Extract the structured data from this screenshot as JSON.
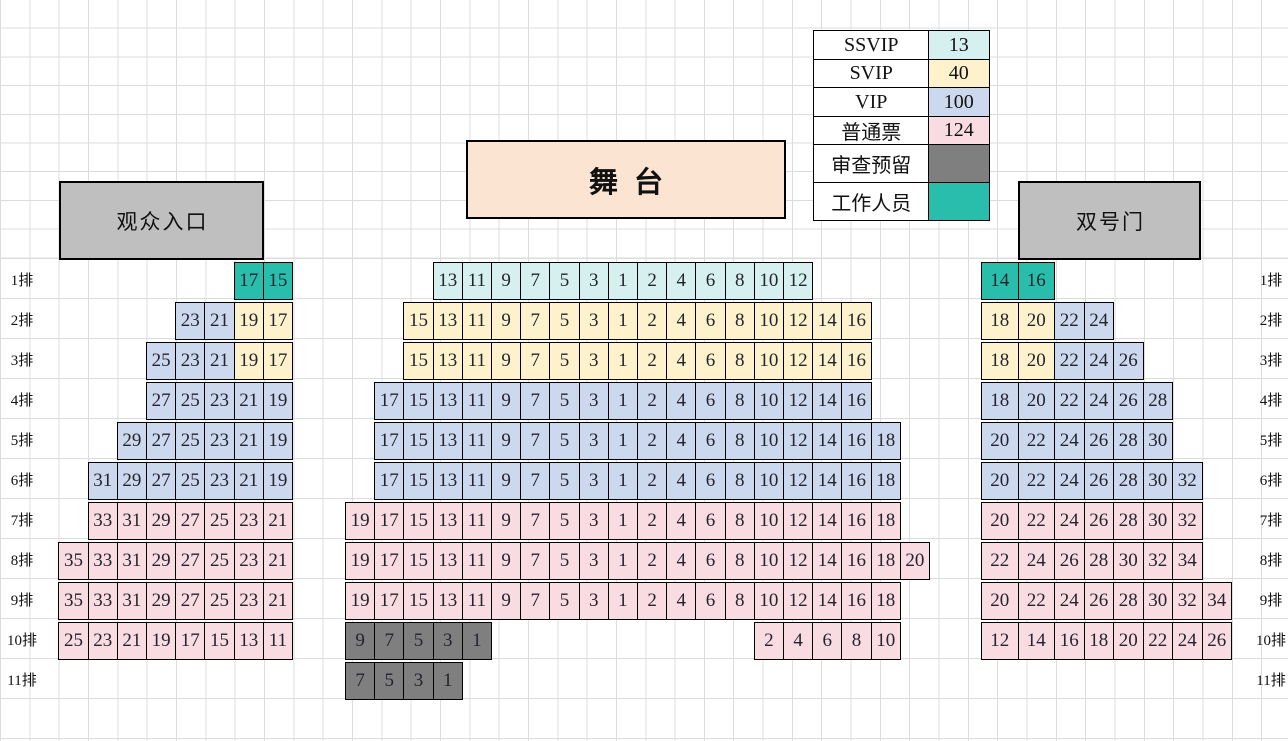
{
  "legend": {
    "rows": [
      {
        "label": "SSVIP",
        "value": "13",
        "type": "ssvip"
      },
      {
        "label": "SVIP",
        "value": "40",
        "type": "svip"
      },
      {
        "label": "VIP",
        "value": "100",
        "type": "vip"
      },
      {
        "label": "普通票",
        "value": "124",
        "type": "normal"
      },
      {
        "label": "审查预留",
        "value": "",
        "type": "reserved"
      },
      {
        "label": "工作人员",
        "value": "",
        "type": "staff"
      }
    ]
  },
  "stage": {
    "label": "舞台"
  },
  "gates": {
    "left": "观众入口",
    "right": "双号门"
  },
  "row_labels": [
    "1排",
    "2排",
    "3排",
    "4排",
    "5排",
    "6排",
    "7排",
    "8排",
    "9排",
    "10排",
    "11排"
  ],
  "colors": {
    "ssvip": "#d5f0ee",
    "svip": "#fdf2cc",
    "vip": "#ccd8ee",
    "normal": "#f9dbe2",
    "reserved": "#7f7f7f",
    "staff": "#29beac",
    "stage": "#fce4d2",
    "gate": "#bfbfbf"
  },
  "seat_blocks": [
    {
      "name": "left",
      "rows": [
        {
          "row": 1,
          "col": 6,
          "segs": [
            {
              "type": "staff",
              "seats": [
                "17",
                "15"
              ]
            }
          ]
        },
        {
          "row": 2,
          "col": 4,
          "segs": [
            {
              "type": "vip",
              "seats": [
                "23",
                "21"
              ]
            },
            {
              "type": "svip",
              "seats": [
                "19",
                "17"
              ]
            }
          ]
        },
        {
          "row": 3,
          "col": 3,
          "segs": [
            {
              "type": "vip",
              "seats": [
                "25",
                "23",
                "21"
              ]
            },
            {
              "type": "svip",
              "seats": [
                "19",
                "17"
              ]
            }
          ]
        },
        {
          "row": 4,
          "col": 3,
          "segs": [
            {
              "type": "vip",
              "seats": [
                "27",
                "25",
                "23",
                "21",
                "19"
              ]
            }
          ]
        },
        {
          "row": 5,
          "col": 2,
          "segs": [
            {
              "type": "vip",
              "seats": [
                "29",
                "27",
                "25",
                "23",
                "21",
                "19"
              ]
            }
          ]
        },
        {
          "row": 6,
          "col": 1,
          "segs": [
            {
              "type": "vip",
              "seats": [
                "31",
                "29",
                "27",
                "25",
                "23",
                "21",
                "19"
              ]
            }
          ]
        },
        {
          "row": 7,
          "col": 1,
          "segs": [
            {
              "type": "normal",
              "seats": [
                "33",
                "31",
                "29",
                "27",
                "25",
                "23",
                "21"
              ]
            }
          ]
        },
        {
          "row": 8,
          "col": 0,
          "segs": [
            {
              "type": "normal",
              "seats": [
                "35",
                "33",
                "31",
                "29",
                "27",
                "25",
                "23",
                "21"
              ]
            }
          ]
        },
        {
          "row": 9,
          "col": 0,
          "segs": [
            {
              "type": "normal",
              "seats": [
                "35",
                "33",
                "31",
                "29",
                "27",
                "25",
                "23",
                "21"
              ]
            }
          ]
        },
        {
          "row": 10,
          "col": 0,
          "segs": [
            {
              "type": "normal",
              "seats": [
                "25",
                "23",
                "21",
                "19",
                "17",
                "15",
                "13",
                "11"
              ]
            }
          ]
        }
      ]
    },
    {
      "name": "center",
      "rows": [
        {
          "row": 1,
          "col": 3,
          "segs": [
            {
              "type": "ssvip",
              "seats": [
                "13",
                "11",
                "9",
                "7",
                "5",
                "3",
                "1",
                "2",
                "4",
                "6",
                "8",
                "10",
                "12"
              ]
            }
          ]
        },
        {
          "row": 2,
          "col": 2,
          "segs": [
            {
              "type": "svip",
              "seats": [
                "15",
                "13",
                "11",
                "9",
                "7",
                "5",
                "3",
                "1",
                "2",
                "4",
                "6",
                "8",
                "10",
                "12",
                "14",
                "16"
              ]
            }
          ]
        },
        {
          "row": 3,
          "col": 2,
          "segs": [
            {
              "type": "svip",
              "seats": [
                "15",
                "13",
                "11",
                "9",
                "7",
                "5",
                "3",
                "1",
                "2",
                "4",
                "6",
                "8",
                "10",
                "12",
                "14",
                "16"
              ]
            }
          ]
        },
        {
          "row": 4,
          "col": 1,
          "segs": [
            {
              "type": "vip",
              "seats": [
                "17",
                "15",
                "13",
                "11",
                "9",
                "7",
                "5",
                "3",
                "1",
                "2",
                "4",
                "6",
                "8",
                "10",
                "12",
                "14",
                "16"
              ]
            }
          ]
        },
        {
          "row": 5,
          "col": 1,
          "segs": [
            {
              "type": "vip",
              "seats": [
                "17",
                "15",
                "13",
                "11",
                "9",
                "7",
                "5",
                "3",
                "1",
                "2",
                "4",
                "6",
                "8",
                "10",
                "12",
                "14",
                "16",
                "18"
              ]
            }
          ]
        },
        {
          "row": 6,
          "col": 1,
          "segs": [
            {
              "type": "vip",
              "seats": [
                "17",
                "15",
                "13",
                "11",
                "9",
                "7",
                "5",
                "3",
                "1",
                "2",
                "4",
                "6",
                "8",
                "10",
                "12",
                "14",
                "16",
                "18"
              ]
            }
          ]
        },
        {
          "row": 7,
          "col": 0,
          "segs": [
            {
              "type": "normal",
              "seats": [
                "19",
                "17",
                "15",
                "13",
                "11",
                "9",
                "7",
                "5",
                "3",
                "1",
                "2",
                "4",
                "6",
                "8",
                "10",
                "12",
                "14",
                "16",
                "18"
              ]
            }
          ]
        },
        {
          "row": 8,
          "col": 0,
          "segs": [
            {
              "type": "normal",
              "seats": [
                "19",
                "17",
                "15",
                "13",
                "11",
                "9",
                "7",
                "5",
                "3",
                "1",
                "2",
                "4",
                "6",
                "8",
                "10",
                "12",
                "14",
                "16",
                "18",
                "20"
              ]
            }
          ]
        },
        {
          "row": 9,
          "col": 0,
          "segs": [
            {
              "type": "normal",
              "seats": [
                "19",
                "17",
                "15",
                "13",
                "11",
                "9",
                "7",
                "5",
                "3",
                "1",
                "2",
                "4",
                "6",
                "8",
                "10",
                "12",
                "14",
                "16",
                "18"
              ]
            }
          ]
        },
        {
          "row": 10,
          "col": 0,
          "segs": [
            {
              "type": "reserved",
              "seats": [
                "9",
                "7",
                "5",
                "3",
                "1"
              ]
            }
          ]
        },
        {
          "row": 10,
          "col": 14,
          "segs": [
            {
              "type": "normal",
              "seats": [
                "2",
                "4",
                "6",
                "8",
                "10"
              ]
            }
          ]
        },
        {
          "row": 11,
          "col": 0,
          "segs": [
            {
              "type": "reserved",
              "seats": [
                "7",
                "5",
                "3",
                "1"
              ]
            }
          ]
        }
      ]
    },
    {
      "name": "right",
      "rows": [
        {
          "row": 1,
          "col": 0,
          "segs": [
            {
              "type": "staff",
              "seats": [
                "14",
                "16"
              ]
            }
          ]
        },
        {
          "row": 2,
          "col": 0,
          "segs": [
            {
              "type": "svip",
              "seats": [
                "18",
                "20"
              ]
            },
            {
              "type": "vip",
              "seats": [
                "22",
                "24"
              ]
            }
          ]
        },
        {
          "row": 3,
          "col": 0,
          "segs": [
            {
              "type": "svip",
              "seats": [
                "18",
                "20"
              ]
            },
            {
              "type": "vip",
              "seats": [
                "22",
                "24",
                "26"
              ]
            }
          ]
        },
        {
          "row": 4,
          "col": 0,
          "segs": [
            {
              "type": "vip",
              "seats": [
                "18",
                "20",
                "22",
                "24",
                "26",
                "28"
              ]
            }
          ]
        },
        {
          "row": 5,
          "col": 0,
          "segs": [
            {
              "type": "vip",
              "seats": [
                "20",
                "22",
                "24",
                "26",
                "28",
                "30"
              ]
            }
          ]
        },
        {
          "row": 6,
          "col": 0,
          "segs": [
            {
              "type": "vip",
              "seats": [
                "20",
                "22",
                "24",
                "26",
                "28",
                "30",
                "32"
              ]
            }
          ]
        },
        {
          "row": 7,
          "col": 0,
          "segs": [
            {
              "type": "normal",
              "seats": [
                "20",
                "22",
                "24",
                "26",
                "28",
                "30",
                "32"
              ]
            }
          ]
        },
        {
          "row": 8,
          "col": 0,
          "segs": [
            {
              "type": "normal",
              "seats": [
                "22",
                "24",
                "26",
                "28",
                "30",
                "32",
                "34"
              ]
            }
          ]
        },
        {
          "row": 9,
          "col": 0,
          "segs": [
            {
              "type": "normal",
              "seats": [
                "20",
                "22",
                "24",
                "26",
                "28",
                "30",
                "32",
                "34"
              ]
            }
          ]
        },
        {
          "row": 10,
          "col": 0,
          "segs": [
            {
              "type": "normal",
              "seats": [
                "12",
                "14",
                "16",
                "18",
                "20",
                "22",
                "24",
                "26"
              ]
            }
          ]
        }
      ]
    }
  ]
}
